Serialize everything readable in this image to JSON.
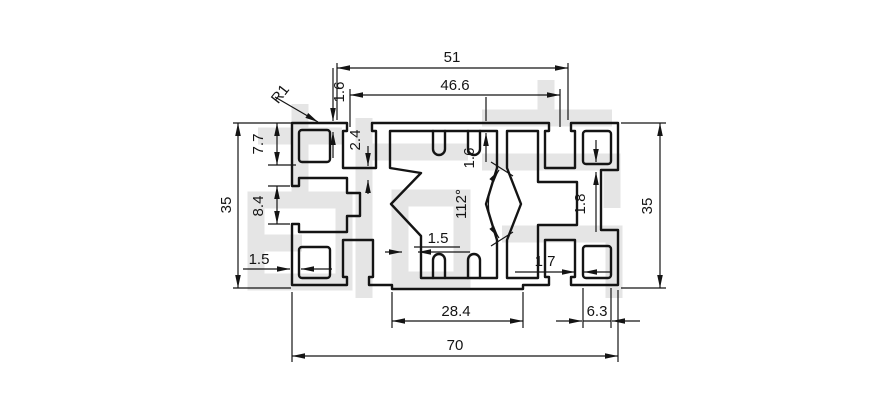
{
  "dims": {
    "top_outer_width": "51",
    "top_inner_width": "46.6",
    "corner_radius": "R1",
    "top_left_wall": "1.6",
    "left_box_depth": "7.7",
    "top_slot_floor": "2.4",
    "left_height": "35",
    "left_slot_height": "8.4",
    "bottom_left_wall": "1.5",
    "center_wall": "1.5",
    "top_center_wall": "1.6",
    "center_angle": "112°",
    "right_wall": "1.8",
    "right_height": "35",
    "bottom_right_wall": "1.7",
    "bottom_center_width": "28.4",
    "bottom_right_width": "6.3",
    "total_width": "70"
  }
}
